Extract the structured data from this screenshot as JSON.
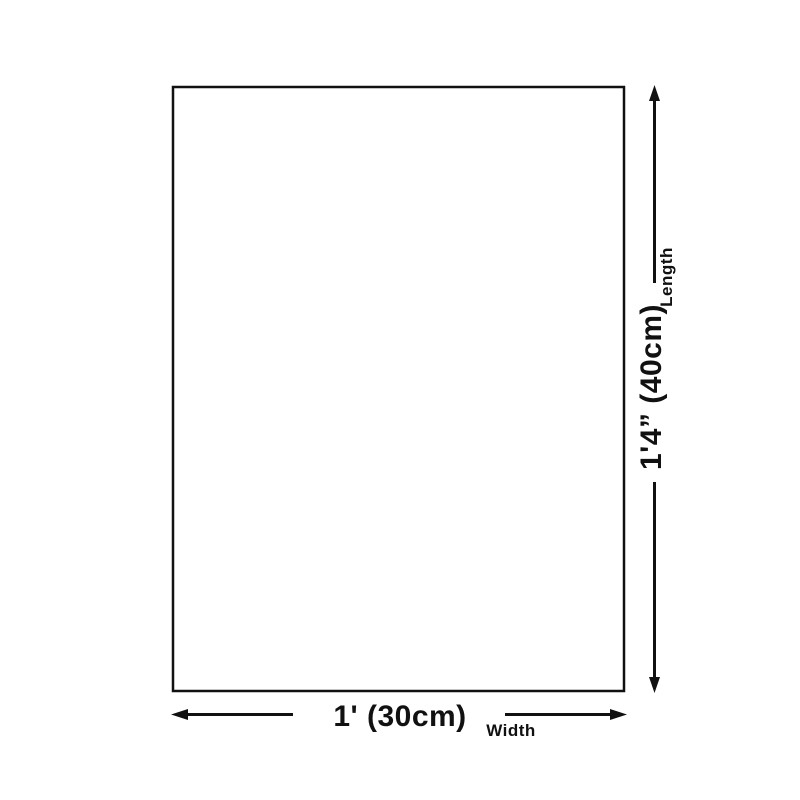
{
  "colors": {
    "background": "#ffffff",
    "line": "#111111",
    "text": "#111111"
  },
  "diagram": {
    "length_value": "1'4” (40cm)",
    "length_label": "Length",
    "width_value": "1' (30cm)",
    "width_label": "Width"
  }
}
